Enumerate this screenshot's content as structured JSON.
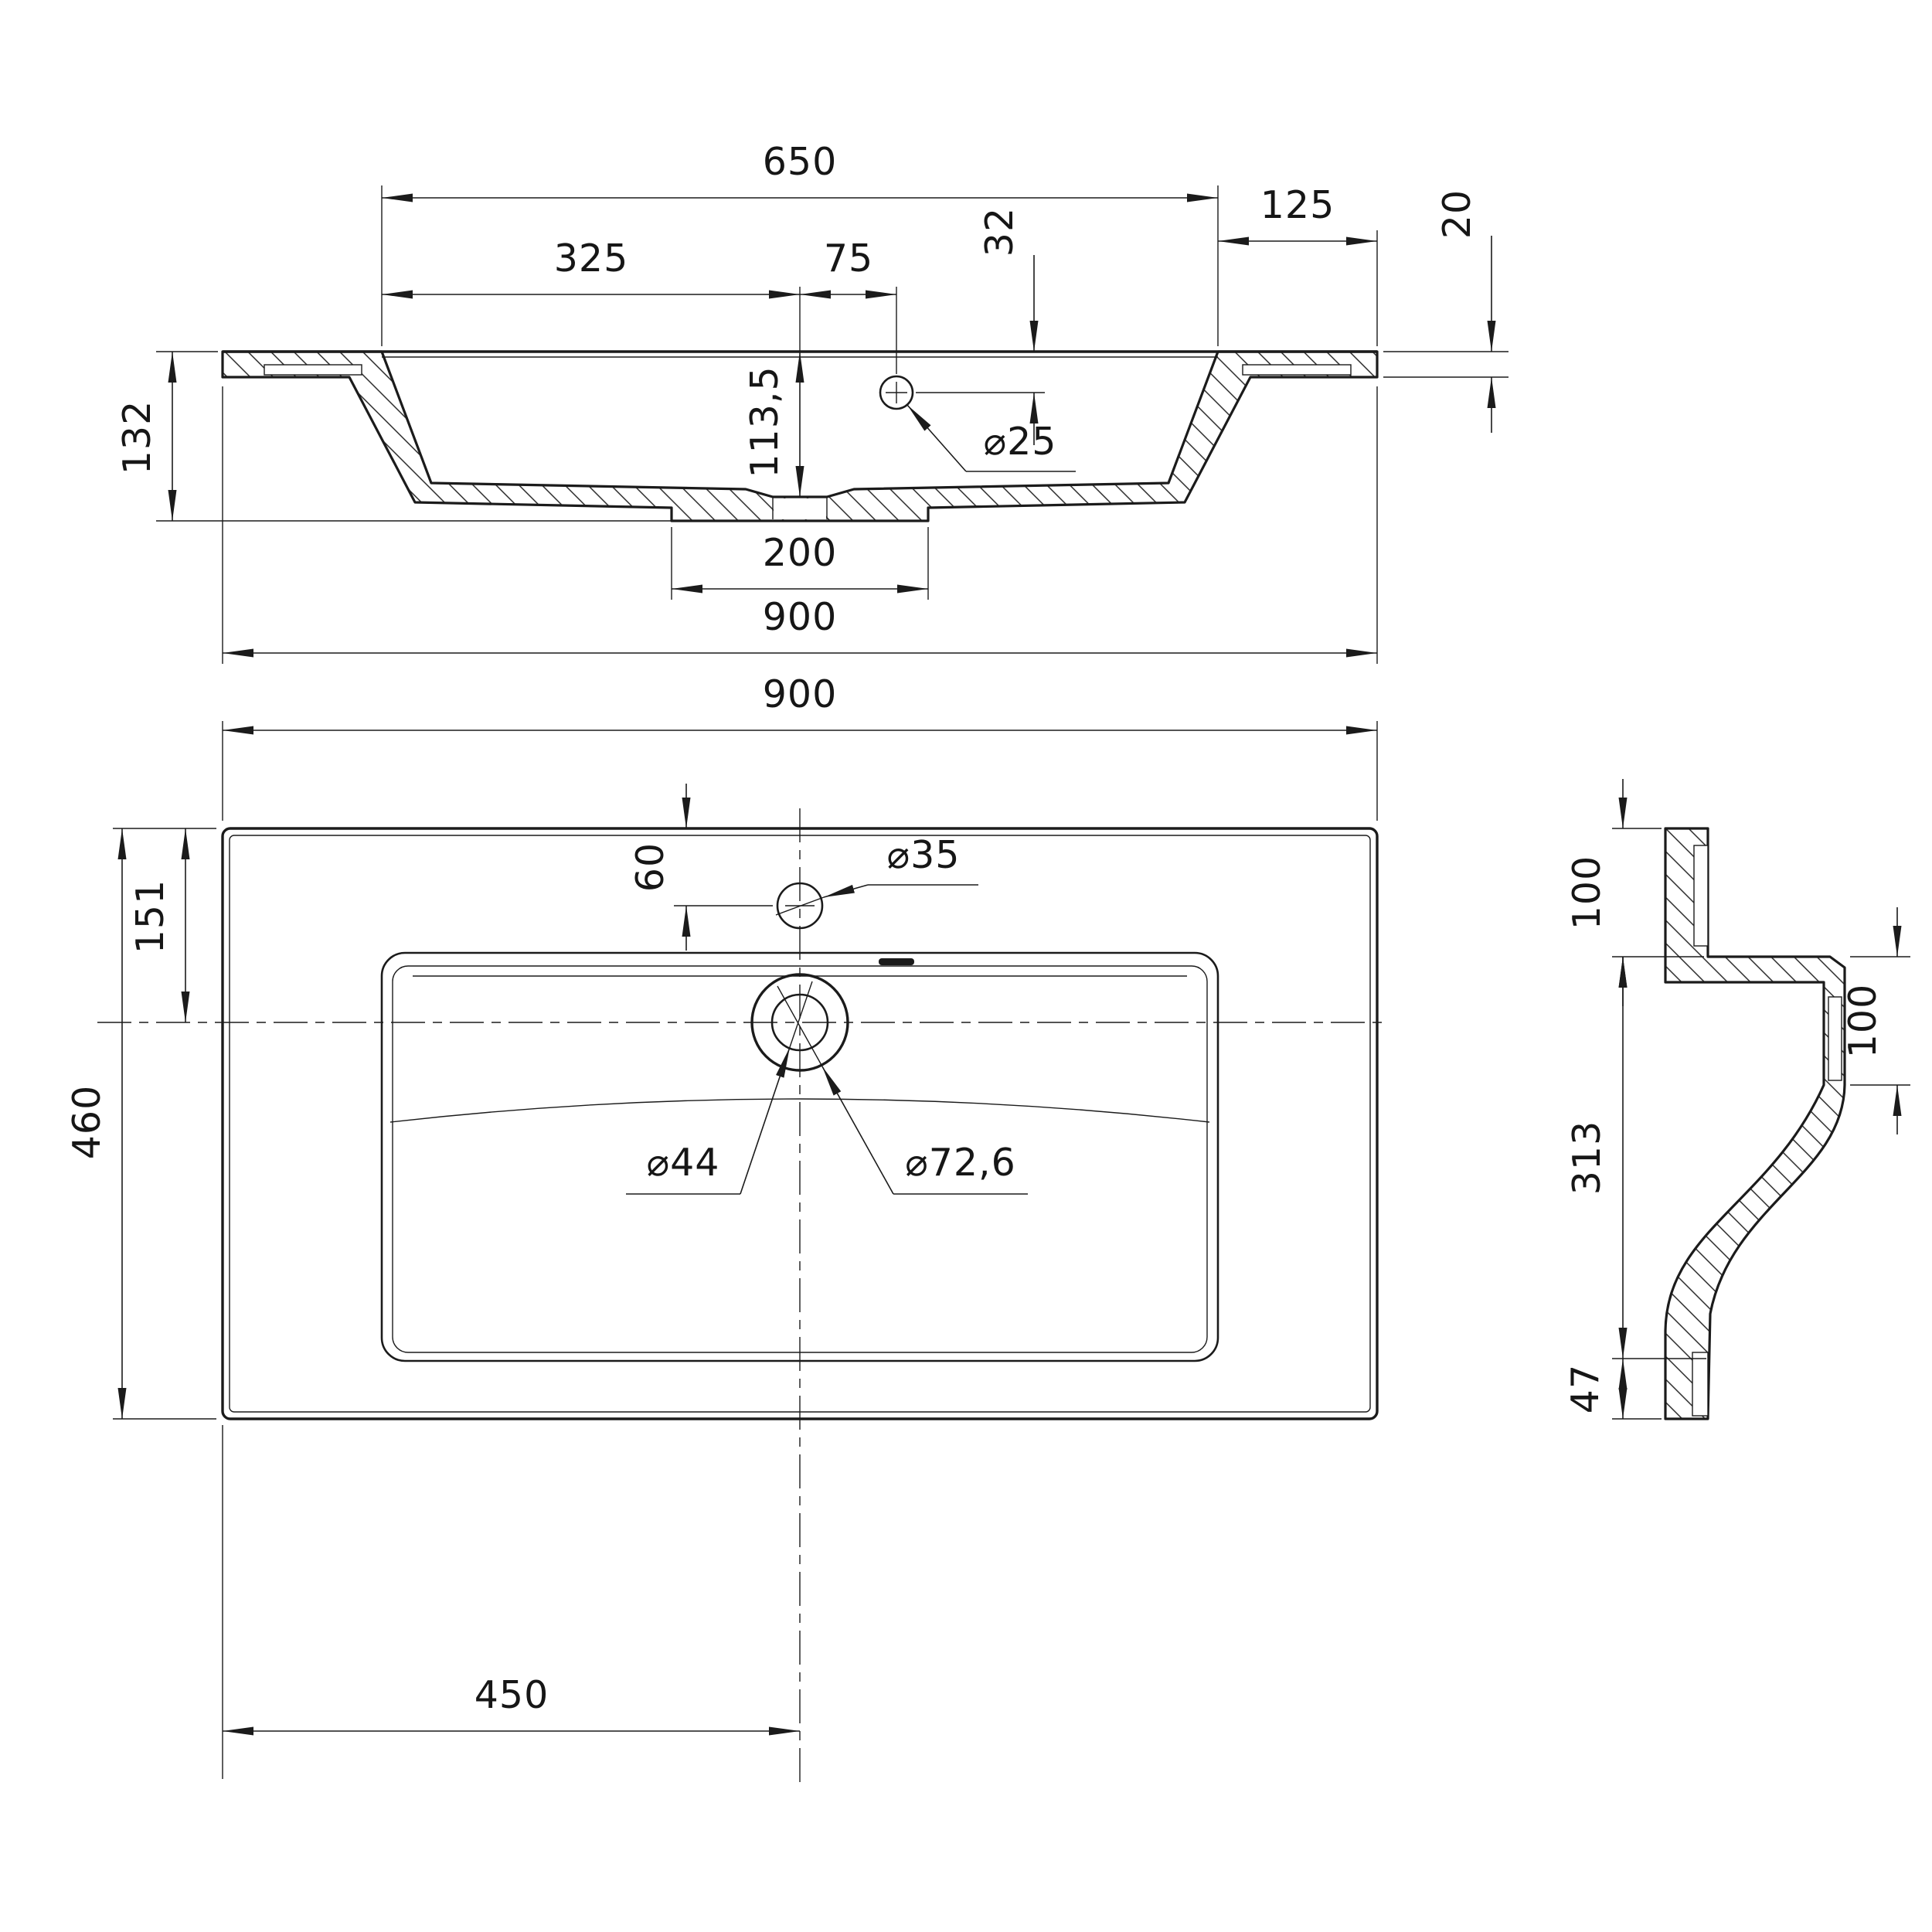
{
  "colors": {
    "background": "#ffffff",
    "ink": "#1b1b1b"
  },
  "front_section": {
    "opening_width": "650",
    "half_opening": "325",
    "tap_hole_offset": "75",
    "tap_hole_drop": "32",
    "overflow_hole_diameter": "⌀25",
    "bowl_depth": "113,5",
    "side_overhang": "125",
    "rim_thickness": "20",
    "overall_height": "132",
    "drain_boss_width": "200",
    "overall_width": "900"
  },
  "plan_view": {
    "overall_width": "900",
    "tap_hole_setback": "60",
    "tap_hole_diameter": "⌀35",
    "bowl_center_setback": "151",
    "overall_depth": "460",
    "drain_hole_diameter": "⌀44",
    "drain_recess_diameter": "⌀72,6",
    "drain_center_offset": "450"
  },
  "side_section": {
    "back_wall_height": "100",
    "front_edge_height": "100",
    "body_height": "313",
    "foot_height": "47"
  }
}
